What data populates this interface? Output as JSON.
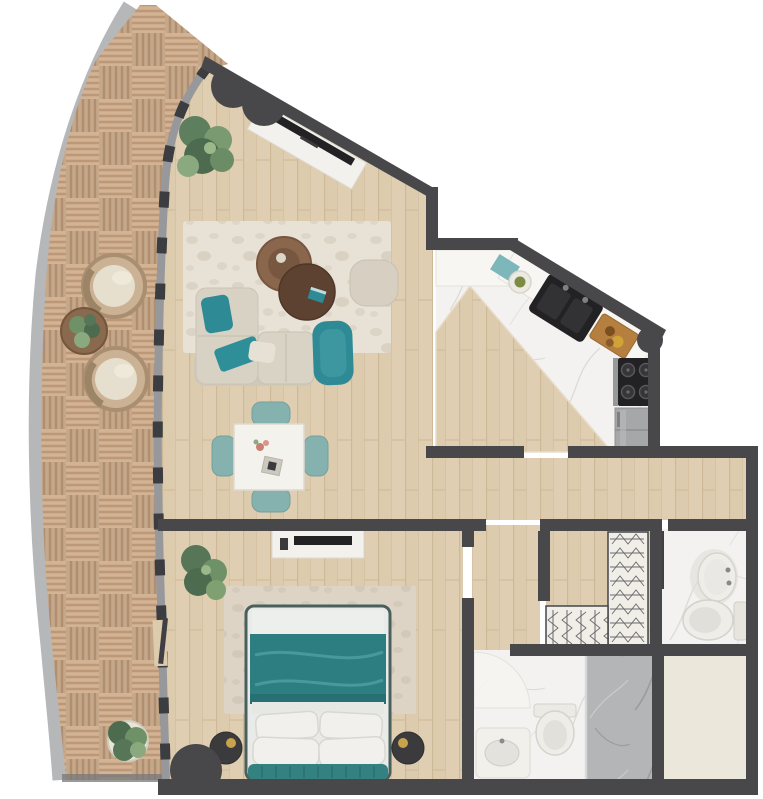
{
  "meta": {
    "kind": "apartment-floor-plan-render",
    "view": "top-down",
    "visible_text": ""
  },
  "palette": {
    "wall": "#48484a",
    "wood_floor": "#ddcbae",
    "wood_line": "#cdb897",
    "deck_light": "#d2b393",
    "deck_stripe": "#bd9878",
    "concrete": "#b6b7b9",
    "glass": "#97989c",
    "mullion": "#3c3d40",
    "marble": "#f3f2f0",
    "shower_marble": "#b3b5b7",
    "rug_living": "#e8e2d6",
    "rug_bedroom": "#ddd4c5",
    "sofa": "#d8d2c5",
    "sofa_shadow": "#cfc9bb",
    "teal": "#2e8a94",
    "teal_light": "#3d97a0",
    "chair_teal": "#85b1af",
    "duvet": "#2d7e81",
    "headboard": "#338180",
    "table_brown": "#8a664c",
    "table_brown_dark": "#5d4231",
    "white_furniture": "#f3f1ed",
    "appliance_black": "#222224",
    "fridge": "#a6a7a9",
    "nightstand": "#3b3b3d",
    "gold": "#c9a24c",
    "plant_mid": "#6f9168",
    "plant_dark": "#4c6b4f",
    "plant_light": "#8aa97f",
    "beige_room": "#ece7db",
    "fixture_white": "#efede8",
    "fixture_stroke": "#d4d2cb",
    "board_wood": "#b5803f",
    "wardrobe_hatch": "#6a6a6e",
    "wardrobe_bg": "#f0eee7"
  },
  "rooms": [
    {
      "id": "balcony",
      "floor": "parquet-deck",
      "items": [
        "wicker-armchair",
        "wicker-armchair",
        "plant-side-table",
        "potted-plant"
      ]
    },
    {
      "id": "living-room",
      "floor": "wood-planks",
      "items": [
        "tv-console",
        "tv",
        "potted-plant",
        "area-rug",
        "sectional-sofa",
        "teal-pillow",
        "teal-throw",
        "teal-lounge-chair",
        "beige-pouf",
        "round-coffee-table",
        "round-coffee-table"
      ]
    },
    {
      "id": "dining-area",
      "floor": "wood-planks",
      "items": [
        "square-dining-table",
        "dining-chair",
        "dining-chair",
        "dining-chair",
        "dining-chair"
      ]
    },
    {
      "id": "kitchen",
      "floor": "marble",
      "items": [
        "counter",
        "double-sink",
        "plate",
        "prep-board",
        "cooktop",
        "refrigerator",
        "wood-island"
      ]
    },
    {
      "id": "hallway",
      "floor": "wood-planks",
      "items": []
    },
    {
      "id": "bedroom",
      "floor": "wood-planks",
      "items": [
        "double-bed",
        "area-rug",
        "nightstand",
        "nightstand",
        "tv-console",
        "potted-plant",
        "door-arc"
      ]
    },
    {
      "id": "walk-in-closet",
      "floor": "wood-planks",
      "items": [
        "wardrobe-rail",
        "wardrobe-rail"
      ]
    },
    {
      "id": "bathroom",
      "floor": "marble",
      "items": [
        "washbasin",
        "toilet",
        "door-leaf"
      ]
    },
    {
      "id": "master-bathroom",
      "floor": "marble",
      "items": [
        "washbasin",
        "toilet",
        "walk-in-shower"
      ]
    },
    {
      "id": "utility-room",
      "floor": "plain",
      "items": []
    }
  ],
  "entrance": {
    "doors": 2,
    "style": "dark-swing-arc"
  }
}
